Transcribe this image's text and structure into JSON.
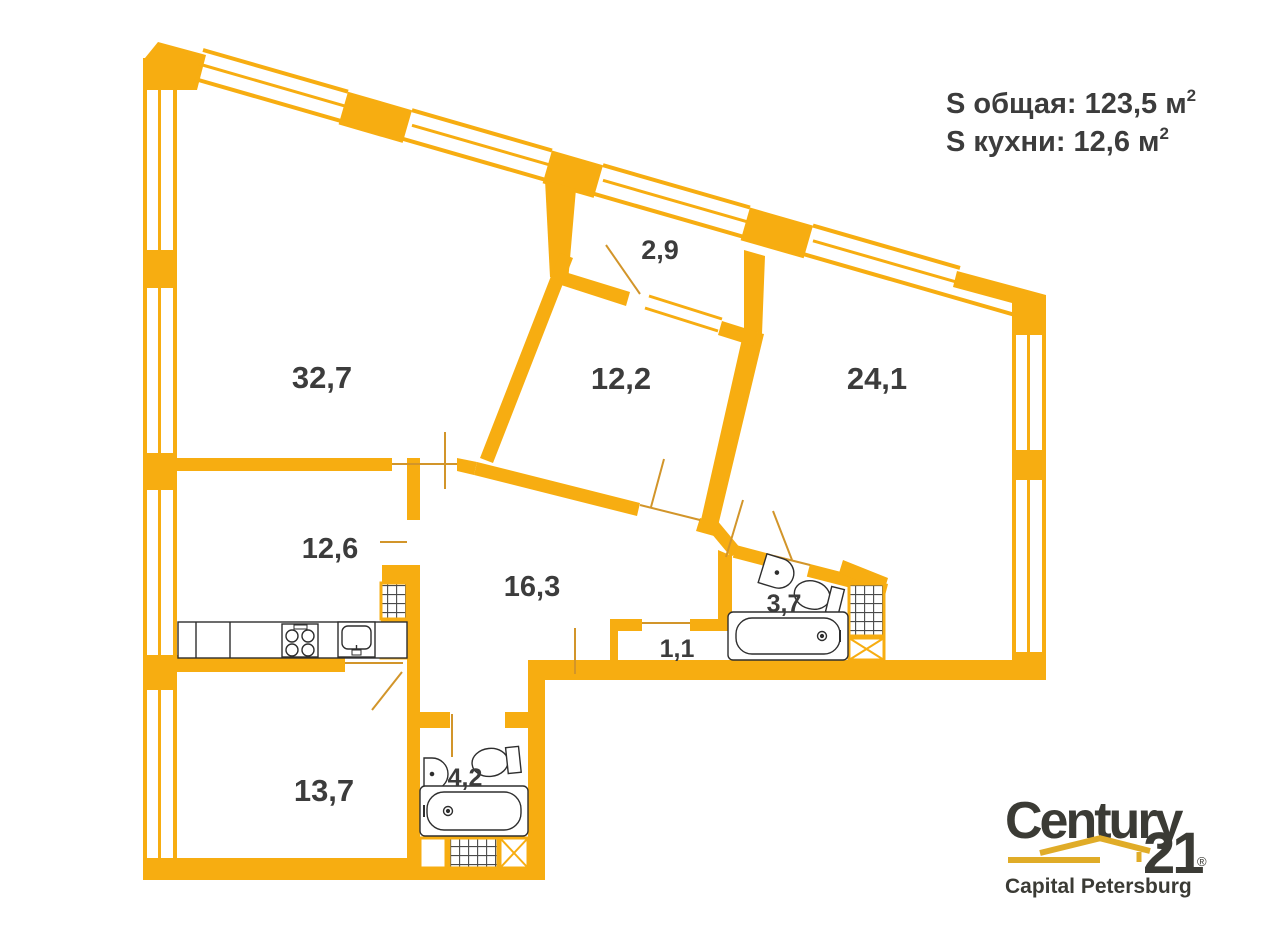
{
  "header": {
    "total_label": "S общая:",
    "total_value": "123,5 м",
    "total_sup": "2",
    "kitchen_label": "S кухни:",
    "kitchen_value": "12,6 м",
    "kitchen_sup": "2"
  },
  "rooms": {
    "living": "32,7",
    "balcony": "2,9",
    "bedroom_mid": "12,2",
    "bedroom_right": "24,1",
    "kitchen": "12,6",
    "hallway": "16,3",
    "closet": "1,1",
    "bathroom_small": "3,7",
    "bathroom_big": "4,2",
    "bedroom_left": "13,7"
  },
  "logo": {
    "brand": "Century",
    "number": "21",
    "reg": "®",
    "subtitle": "Capital Petersburg"
  },
  "colors": {
    "wall_yellow": "#F7AD11",
    "label_dark": "#3C3C3C",
    "logo_gold": "#E0AC28",
    "logo_text": "#3B3B35"
  }
}
